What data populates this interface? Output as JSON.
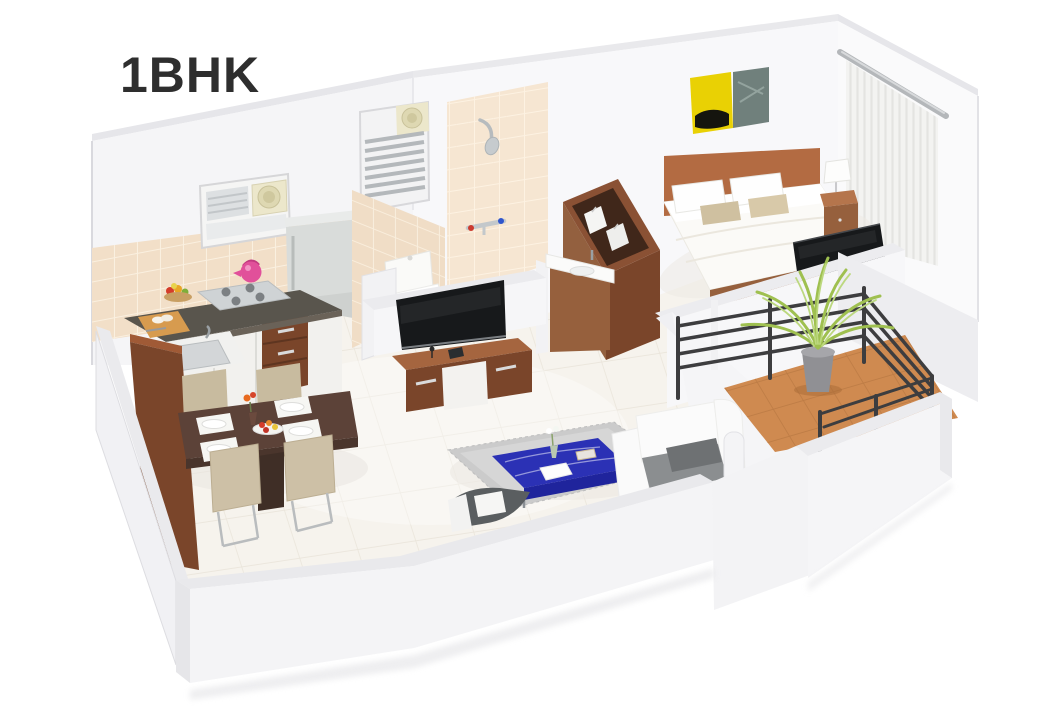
{
  "header": {
    "title": "1BHK"
  },
  "floor_plan": {
    "kind": "3d-isometric-apartment-render",
    "unit_type": "1BHK",
    "rooms": [
      {
        "id": "kitchen",
        "items": [
          "tiled-backsplash",
          "window-with-exhaust-fan",
          "refrigerator",
          "gas-stove",
          "pink-kettle",
          "fruit-bowl",
          "chopping-board",
          "sink",
          "white-cabinets",
          "wooden-drawer-unit",
          "wooden-divider-panel"
        ]
      },
      {
        "id": "dining-area",
        "items": [
          "wooden-dining-table",
          "four-beige-chairs",
          "four-place-settings",
          "fruit-plate",
          "flower-vase"
        ]
      },
      {
        "id": "bathroom",
        "items": [
          "tiled-walls",
          "louvered-vent-with-fan",
          "shower",
          "mixer-taps",
          "toilet",
          "wooden-wash-basin-vanity",
          "half-walls"
        ]
      },
      {
        "id": "bedroom",
        "items": [
          "double-bed",
          "wooden-headboard",
          "white-pillows",
          "beige-accent-pillows",
          "bedside-table",
          "table-lamp",
          "two-panel-wall-art",
          "sheer-curtains-with-rod",
          "flat-screen-tv",
          "open-top-wardrobe"
        ]
      },
      {
        "id": "living-room",
        "items": [
          "grey-rug",
          "blue-coffee-table",
          "white-corner-sofa",
          "grey-seat-cushions",
          "floating-tv-unit",
          "flat-screen-tv",
          "white-pillar"
        ]
      },
      {
        "id": "balcony",
        "items": [
          "terracotta-tile-floor",
          "dark-metal-railing",
          "potted-palm-plant"
        ]
      }
    ]
  },
  "colors": {
    "background": "#ffffff",
    "title_text": "#2e2e2e",
    "wall_white": "#f5f5f7",
    "wall_bright": "#fafafb",
    "wall_top": "#ececef",
    "kitchen_tile": "#f2dfc8",
    "bath_tile": "#f6e6d2",
    "floor_tile": "#f6f3ed",
    "balcony_tile": "#cf8a50",
    "counter_top": "#59554d",
    "steel_grey": "#cfd3d5",
    "fridge_grey": "#d9dcda",
    "cabinet_white": "#f2f1ee",
    "wood_dark": "#7a452a",
    "wood_mid": "#96603d",
    "wood_light": "#b36b42",
    "table_wood": "#5c4238",
    "chair_beige": "#c8bb9f",
    "bed_white": "#fbfaf7",
    "pillow_beige": "#cfc0a0",
    "sofa_white": "#fafafa",
    "cushion_grey": "#8b8e90",
    "rug_grey": "#cbcbcb",
    "coffee_table_blue": "#2b31b5",
    "railing_dark": "#3d3d3f",
    "plant_green": "#9fc050",
    "plant_green_light": "#bcd87f",
    "pot_grey": "#909094",
    "kettle_pink": "#e1509a",
    "art_yellow": "#e9d104",
    "art_teal": "#70807c",
    "tv_black": "#17191b",
    "curtain_white": "#f3f3f1",
    "toilet_white": "#fafaf8"
  }
}
